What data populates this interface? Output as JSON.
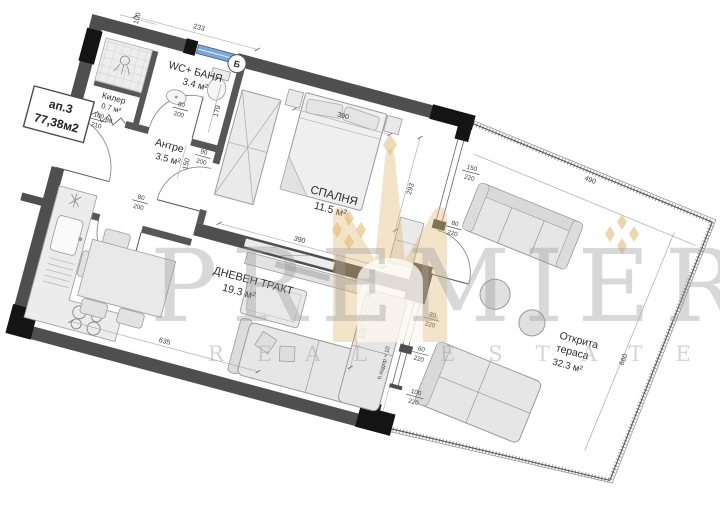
{
  "apartment": {
    "id": "ап.3",
    "total_area": "77,38м2"
  },
  "rooms": {
    "killer": {
      "name": "Килер",
      "area": "0.7 м²"
    },
    "bath": {
      "name": "WC+ БАНЯ",
      "area": "3.4 м²"
    },
    "hall": {
      "name": "Антре",
      "area": "3.5 м²"
    },
    "bedroom": {
      "name": "СПАЛНЯ",
      "area": "11.5 м²"
    },
    "living": {
      "name": "ДНЕВЕН ТРАКТ",
      "area": "19.3 м²"
    },
    "terrace": {
      "name_line1": "Открита",
      "name_line2": "тераса",
      "area": "32.3 м²"
    }
  },
  "section_mark": "Б",
  "dims": {
    "shower_width": "100",
    "bath_top": "233",
    "bedroom_top": "390",
    "killer_width": "88",
    "bath_depth": "179",
    "hall_depth": "150",
    "bedroom_depth": "293",
    "bedroom_bottom": "390",
    "living_right": "330",
    "living_bottom": "635",
    "terrace_top": "490",
    "terrace_side": "660",
    "entry_door_num": "100",
    "entry_door_den": "210",
    "wc_door_num": "80",
    "wc_door_den": "200",
    "bedroom_door_num": "90",
    "bedroom_door_den": "200",
    "passage_door_num": "80",
    "passage_door_den": "200",
    "bedroom_window_num": "150",
    "bedroom_window_den": "220",
    "bedroom_terrace_door_num": "80",
    "bedroom_terrace_door_den": "220",
    "living_window1_num": "80",
    "living_window1_den": "220",
    "living_window2_num": "60",
    "living_window2_den": "220",
    "living_terrace_door_num": "100",
    "living_terrace_door_den": "220",
    "parapet_note": "h подпр ≈ 10"
  },
  "watermark": {
    "title": "PREMIER",
    "subtitle": "REAL ESTATE"
  },
  "colors": {
    "wall": "#4f4f4f",
    "column": "#141414",
    "furniture": "#e8e8e8",
    "window_glass": "#7aa7d6",
    "watermark_gold": "#deb46a"
  }
}
